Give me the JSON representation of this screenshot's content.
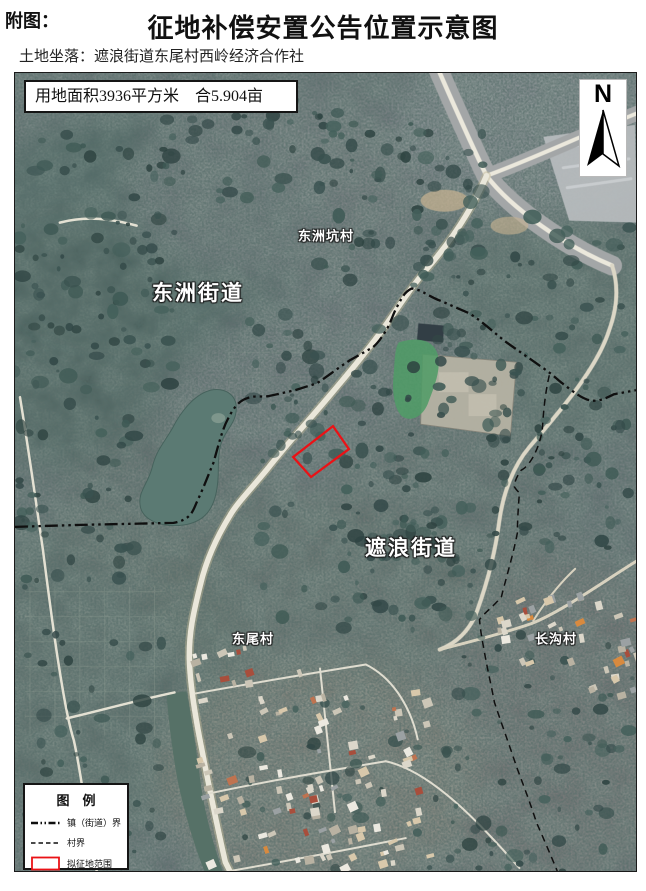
{
  "page": {
    "figure_label": "附图：",
    "title": "征地补偿安置公告位置示意图",
    "location_label": "土地坐落：遮浪街道东尾村西岭经济合作社"
  },
  "map": {
    "area_note": "用地面积3936平方米　合5.904亩",
    "north_label": "N",
    "labels": {
      "dongzhoukeng_village": "东洲坑村",
      "dongzhou_subdistrict": "东洲街道",
      "zhelang_subdistrict": "遮浪街道",
      "dongwei_village": "东尾村",
      "changgou_village": "长沟村"
    },
    "colors": {
      "parcel_outline": "#ea1216",
      "boundary_line": "#0f0f0f",
      "road": "#eae7da",
      "water": "#5b7a73"
    }
  },
  "legend": {
    "title": "图　例",
    "items": [
      {
        "symbol": "town-street-boundary-line",
        "label": "镇（街道）界"
      },
      {
        "symbol": "village-boundary-line",
        "label": "村界"
      },
      {
        "symbol": "proposed-acquisition-outline",
        "label": "拟征地范围"
      }
    ]
  }
}
